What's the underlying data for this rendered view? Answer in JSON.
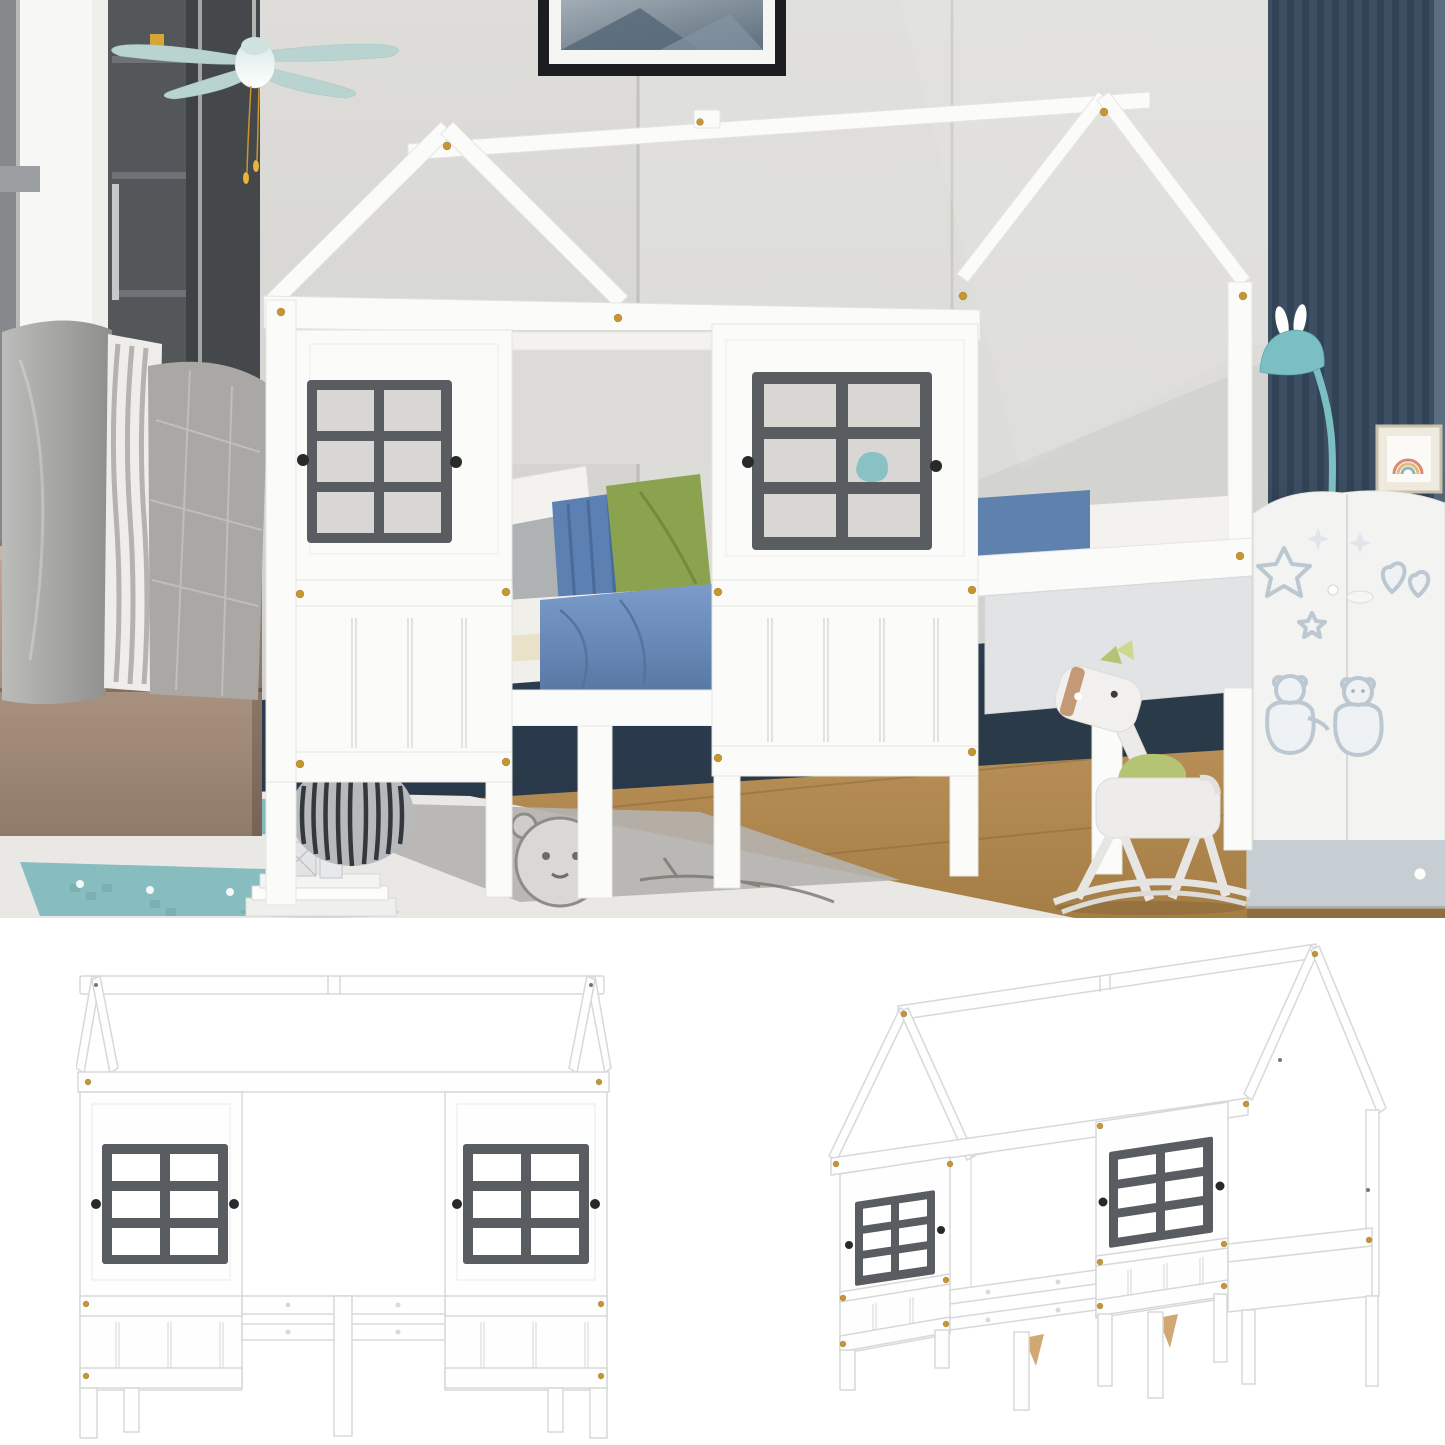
{
  "image": {
    "type": "product-photo-composite",
    "alt": "White twin house-shaped kids bed with two gray playhouse windows, shown staged in a bedroom and as two plain frame views on white"
  },
  "colors": {
    "bed-white": "#fbfbfa",
    "window-dark": "#595d61",
    "pane": "#d8d7d4",
    "knob-dark": "#27292b",
    "gold": "#c9952f",
    "shelf": "#54575a",
    "shelf-dark": "#45484b",
    "fan-mint": "#b9d4d0",
    "wood": "#b19a87",
    "shadow-navy": "#243649",
    "blanket": "#6f94c5",
    "pillow-blue": "#5c80b2",
    "pillow-green": "#8ba24f",
    "sheet": "#f1efe9",
    "slat": "#3d4f63",
    "teal": "#7bbfc3",
    "wardrobe": "#f3f3f2",
    "wardrobe-accent": "#c6ced4",
    "decal": "#bcc8d1",
    "rug": "#eae8e4",
    "rug-gray": "#b5b3af",
    "rug-teal": "#7db8bb",
    "horse-tan": "#c49a76",
    "horse-green": "#b5c474",
    "drawing-stroke": "#d8d8d6"
  },
  "photo": {
    "alt": "Lifestyle photo of white house-frame daybed in a kids bedroom",
    "objects": {
      "picture_frame": "framed abstract art",
      "ceiling_fan": "mint ceiling fan with pull chains",
      "window": "bright side window",
      "bookshelf": "charcoal shelf tower",
      "throw_pillows": "gray throw pillows",
      "wood_chest": "oak storage chest",
      "house_bed": "white house-frame bed with gray windows",
      "bedding": "blue and green bedding with pillows",
      "pouf": "striped storage pouf",
      "slat_wall": "navy slat accent wall",
      "bunny_lamp": "teal bunny floor lamp",
      "rainbow_frame": "small rainbow art frame",
      "wardrobe": "white kids wardrobe with teddy bear decals",
      "rocking_horse": "white rocking horse with green mane",
      "rug": "gray and teal kids rug with bear motif",
      "books": "book stack with silver ornaments",
      "floor": "oak wood floor"
    }
  },
  "views": {
    "front": {
      "alt": "Front elevation line view of the house bed frame"
    },
    "perspective": {
      "alt": "Angled line view of the house bed frame"
    }
  },
  "window_grid": {
    "columns": 2,
    "rows": 3
  }
}
